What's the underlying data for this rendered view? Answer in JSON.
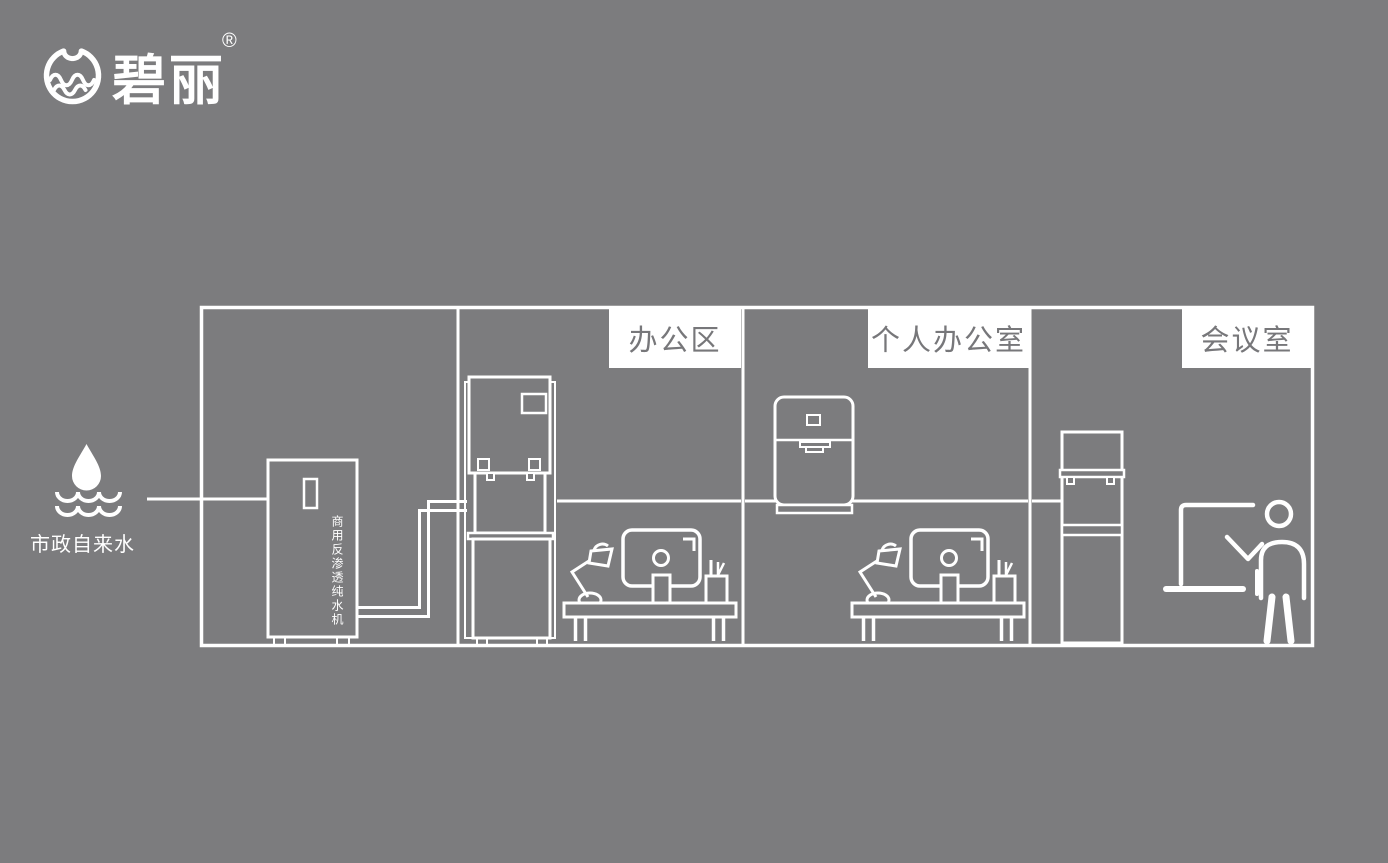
{
  "canvas": {
    "bg_color": "#7c7c7e",
    "line_color": "#ffffff",
    "label_bg": "#ffffff",
    "label_text_color": "#77777a"
  },
  "logo": {
    "brand": "碧丽",
    "registered": "®",
    "icon": "water-cup-circle-icon"
  },
  "water_source": {
    "label": "市政自来水",
    "icons": [
      "water-drop-icon",
      "waves-icon"
    ]
  },
  "purifier": {
    "label": "商用反渗透纯水机"
  },
  "rooms": [
    {
      "label": "办公区"
    },
    {
      "label": "个人办公室"
    },
    {
      "label": "会议室"
    }
  ],
  "icons": {
    "logo": "water-cup-circle-icon",
    "source": "water-drop-icon",
    "office_equipment": [
      "desk-lamp-icon",
      "monitor-icon",
      "pen-cup-icon"
    ],
    "meeting_room": [
      "presentation-board-icon",
      "presenter-icon"
    ],
    "dispensers": [
      "floor-standing-dispenser",
      "countertop-dispenser",
      "slim-floor-dispenser"
    ]
  }
}
